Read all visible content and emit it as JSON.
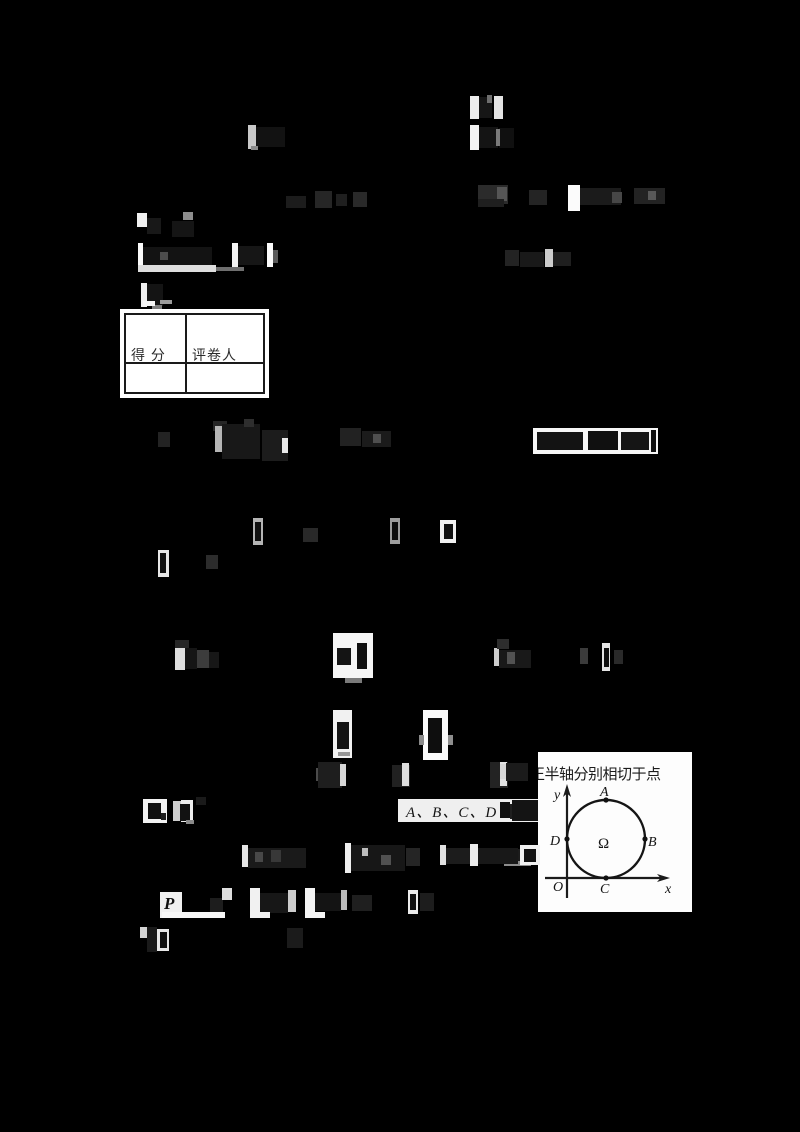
{
  "colors": {
    "page_background": "#000000",
    "paper_white": "#ffffff",
    "ink": "#1b1b1b"
  },
  "score_table": {
    "score_label": "得 分",
    "grader_label": "评卷人"
  },
  "figure": {
    "caption": "正半轴分别相切于点",
    "labels": {
      "y_axis": "y",
      "x_axis": "x",
      "origin": "O",
      "point_a": "A",
      "point_b": "B",
      "point_c": "C",
      "point_d": "D",
      "center": "Ω"
    }
  },
  "text_fragments": {
    "options": "A、B、C、D",
    "p_symbol": "P"
  },
  "fragments": [
    [
      470,
      96,
      9,
      23,
      "#ededed"
    ],
    [
      479,
      97,
      13,
      21,
      "#161616"
    ],
    [
      487,
      95,
      5,
      8,
      "#6e6e6e"
    ],
    [
      494,
      96,
      9,
      23,
      "#e3e3e3"
    ],
    [
      470,
      125,
      9,
      25,
      "#f3f3f3"
    ],
    [
      479,
      127,
      19,
      21,
      "#141414"
    ],
    [
      499,
      128,
      15,
      20,
      "#101010"
    ],
    [
      496,
      129,
      4,
      17,
      "#7a7a7a"
    ],
    [
      248,
      125,
      8,
      24,
      "#c9c9c9"
    ],
    [
      256,
      127,
      29,
      20,
      "#121212"
    ],
    [
      251,
      146,
      7,
      4,
      "#8a8a8a"
    ],
    [
      286,
      196,
      20,
      12,
      "#1c1c1c"
    ],
    [
      315,
      191,
      17,
      17,
      "#262626"
    ],
    [
      336,
      194,
      11,
      12,
      "#1f1f1f"
    ],
    [
      353,
      192,
      14,
      15,
      "#292929"
    ],
    [
      478,
      185,
      30,
      19,
      "#2b2b2b"
    ],
    [
      497,
      187,
      10,
      14,
      "#555555"
    ],
    [
      478,
      199,
      26,
      8,
      "#1f1f1f"
    ],
    [
      529,
      190,
      18,
      15,
      "#242424"
    ],
    [
      568,
      185,
      12,
      26,
      "#fbfbfb"
    ],
    [
      580,
      188,
      41,
      17,
      "#1b1b1b"
    ],
    [
      612,
      192,
      10,
      11,
      "#474747"
    ],
    [
      634,
      188,
      31,
      16,
      "#232323"
    ],
    [
      648,
      191,
      8,
      9,
      "#585858"
    ],
    [
      137,
      213,
      10,
      14,
      "#f0f0f0"
    ],
    [
      147,
      218,
      14,
      16,
      "#181818"
    ],
    [
      183,
      212,
      10,
      8,
      "#8d8d8d"
    ],
    [
      172,
      221,
      22,
      16,
      "#151515"
    ],
    [
      138,
      243,
      5,
      25,
      "#fafafa"
    ],
    [
      143,
      247,
      69,
      18,
      "#131313"
    ],
    [
      160,
      252,
      8,
      8,
      "#4d4d4d"
    ],
    [
      138,
      265,
      78,
      7,
      "#dedede"
    ],
    [
      216,
      267,
      28,
      4,
      "#6f6f6f"
    ],
    [
      232,
      243,
      6,
      24,
      "#f4f4f4"
    ],
    [
      238,
      246,
      26,
      19,
      "#161616"
    ],
    [
      267,
      243,
      6,
      24,
      "#fafafa"
    ],
    [
      273,
      250,
      5,
      13,
      "#5a5a5a"
    ],
    [
      505,
      250,
      14,
      16,
      "#232323"
    ],
    [
      520,
      252,
      24,
      15,
      "#191919"
    ],
    [
      545,
      249,
      8,
      18,
      "#cccccc"
    ],
    [
      553,
      252,
      18,
      14,
      "#1f1f1f"
    ],
    [
      141,
      283,
      6,
      24,
      "#efefef"
    ],
    [
      147,
      284,
      16,
      22,
      "#141414"
    ],
    [
      152,
      305,
      10,
      4,
      "#7c7c7c"
    ],
    [
      143,
      301,
      12,
      5,
      "#f5f5f5"
    ],
    [
      160,
      300,
      12,
      4,
      "#9b9b9b"
    ],
    [
      158,
      432,
      12,
      15,
      "#232323"
    ],
    [
      213,
      421,
      14,
      10,
      "#262626"
    ],
    [
      215,
      426,
      7,
      26,
      "#b5b5b5"
    ],
    [
      222,
      424,
      38,
      35,
      "#181818"
    ],
    [
      244,
      419,
      10,
      8,
      "#2e2e2e"
    ],
    [
      262,
      430,
      26,
      31,
      "#1c1c1c"
    ],
    [
      282,
      438,
      6,
      15,
      "#e9e9e9"
    ],
    [
      340,
      428,
      21,
      18,
      "#222222"
    ],
    [
      362,
      431,
      29,
      16,
      "#1b1b1b"
    ],
    [
      373,
      434,
      8,
      9,
      "#4f4f4f"
    ],
    [
      533,
      428,
      125,
      26,
      "#f6f6f6"
    ],
    [
      537,
      432,
      46,
      18,
      "#131313"
    ],
    [
      588,
      431,
      30,
      19,
      "#101010"
    ],
    [
      621,
      432,
      28,
      18,
      "#151515"
    ],
    [
      651,
      430,
      5,
      22,
      "#111111"
    ],
    [
      253,
      518,
      10,
      27,
      "#b4b4b4"
    ],
    [
      255,
      522,
      6,
      19,
      "#101010"
    ],
    [
      303,
      528,
      15,
      14,
      "#292929"
    ],
    [
      390,
      518,
      10,
      26,
      "#9e9e9e"
    ],
    [
      392,
      522,
      6,
      18,
      "#0f0f0f"
    ],
    [
      440,
      520,
      16,
      23,
      "#f1f1f1"
    ],
    [
      444,
      524,
      9,
      15,
      "#111111"
    ],
    [
      158,
      550,
      11,
      27,
      "#e7e7e7"
    ],
    [
      160,
      553,
      6,
      20,
      "#101010"
    ],
    [
      206,
      555,
      12,
      14,
      "#2c2c2c"
    ],
    [
      175,
      640,
      14,
      8,
      "#272727"
    ],
    [
      175,
      648,
      10,
      22,
      "#dedede"
    ],
    [
      185,
      648,
      12,
      21,
      "#151515"
    ],
    [
      197,
      650,
      12,
      18,
      "#3c3c3c"
    ],
    [
      209,
      652,
      10,
      16,
      "#171717"
    ],
    [
      333,
      633,
      40,
      45,
      "#f5f5f5"
    ],
    [
      337,
      648,
      14,
      17,
      "#141414"
    ],
    [
      357,
      643,
      10,
      26,
      "#0f0f0f"
    ],
    [
      345,
      678,
      17,
      5,
      "#7a7a7a"
    ],
    [
      494,
      648,
      5,
      18,
      "#cdcdcd"
    ],
    [
      497,
      639,
      12,
      10,
      "#2d2d2d"
    ],
    [
      499,
      650,
      32,
      18,
      "#191919"
    ],
    [
      507,
      652,
      8,
      12,
      "#525252"
    ],
    [
      580,
      648,
      8,
      16,
      "#3b3b3b"
    ],
    [
      602,
      643,
      8,
      28,
      "#e4e4e4"
    ],
    [
      604,
      648,
      5,
      19,
      "#0f0f0f"
    ],
    [
      614,
      650,
      9,
      14,
      "#2a2a2a"
    ],
    [
      333,
      710,
      19,
      48,
      "#f1f1f1"
    ],
    [
      337,
      722,
      12,
      27,
      "#131313"
    ],
    [
      338,
      752,
      12,
      4,
      "#969696"
    ],
    [
      423,
      710,
      25,
      50,
      "#fafafa"
    ],
    [
      428,
      718,
      14,
      35,
      "#0e0e0e"
    ],
    [
      419,
      735,
      5,
      10,
      "#898989"
    ],
    [
      448,
      735,
      5,
      10,
      "#8e8e8e"
    ],
    [
      316,
      768,
      8,
      13,
      "#4b4b4b"
    ],
    [
      318,
      762,
      24,
      26,
      "#1e1e1e"
    ],
    [
      340,
      764,
      6,
      22,
      "#d6d6d6"
    ],
    [
      392,
      765,
      18,
      22,
      "#212121"
    ],
    [
      402,
      763,
      7,
      23,
      "#dedede"
    ],
    [
      490,
      762,
      18,
      26,
      "#232323"
    ],
    [
      500,
      762,
      7,
      24,
      "#e2e2e2"
    ],
    [
      500,
      764,
      6,
      15,
      "#d6d6d6"
    ],
    [
      506,
      763,
      22,
      18,
      "#1b1b1b"
    ],
    [
      500,
      802,
      10,
      16,
      "#101010"
    ],
    [
      510,
      804,
      24,
      15,
      "#1f1f1f"
    ],
    [
      514,
      807,
      8,
      8,
      "#565656"
    ],
    [
      502,
      849,
      30,
      13,
      "#1c1c1c"
    ],
    [
      504,
      861,
      27,
      5,
      "#8c8c8c"
    ],
    [
      143,
      799,
      24,
      24,
      "#f2f2f2"
    ],
    [
      148,
      803,
      13,
      16,
      "#101010"
    ],
    [
      161,
      813,
      5,
      7,
      "#1e1e1e"
    ],
    [
      173,
      801,
      8,
      20,
      "#cecece"
    ],
    [
      181,
      800,
      12,
      22,
      "#eeeeee"
    ],
    [
      180,
      804,
      10,
      17,
      "#121212"
    ],
    [
      186,
      820,
      8,
      4,
      "#8a8a8a"
    ],
    [
      196,
      797,
      10,
      8,
      "#1a1a1a"
    ],
    [
      512,
      800,
      26,
      21,
      "#141414"
    ],
    [
      242,
      845,
      6,
      22,
      "#e6e6e6"
    ],
    [
      248,
      848,
      58,
      20,
      "#1a1a1a"
    ],
    [
      255,
      852,
      8,
      10,
      "#484848"
    ],
    [
      271,
      850,
      10,
      12,
      "#383838"
    ],
    [
      345,
      843,
      6,
      30,
      "#efefef"
    ],
    [
      351,
      845,
      54,
      26,
      "#171717"
    ],
    [
      362,
      848,
      6,
      8,
      "#bdbdbd"
    ],
    [
      381,
      855,
      10,
      10,
      "#515151"
    ],
    [
      406,
      848,
      14,
      18,
      "#252525"
    ],
    [
      440,
      845,
      6,
      20,
      "#e2e2e2"
    ],
    [
      446,
      848,
      24,
      16,
      "#1c1c1c"
    ],
    [
      470,
      844,
      8,
      22,
      "#ececec"
    ],
    [
      478,
      848,
      40,
      16,
      "#181818"
    ],
    [
      520,
      845,
      20,
      20,
      "#f0f0f0"
    ],
    [
      524,
      849,
      12,
      13,
      "#111111"
    ],
    [
      210,
      898,
      13,
      16,
      "#1d1d1d"
    ],
    [
      222,
      888,
      10,
      12,
      "#dedede"
    ],
    [
      250,
      888,
      10,
      26,
      "#f1f1f1"
    ],
    [
      260,
      893,
      28,
      20,
      "#171717"
    ],
    [
      288,
      890,
      8,
      22,
      "#cdcdcd"
    ],
    [
      305,
      888,
      10,
      24,
      "#f4f4f4"
    ],
    [
      315,
      893,
      26,
      18,
      "#141414"
    ],
    [
      341,
      890,
      6,
      20,
      "#bbbbbb"
    ],
    [
      352,
      895,
      20,
      16,
      "#1f1f1f"
    ],
    [
      408,
      890,
      10,
      24,
      "#ebebeb"
    ],
    [
      410,
      894,
      6,
      16,
      "#101010"
    ],
    [
      420,
      893,
      14,
      18,
      "#1d1d1d"
    ],
    [
      162,
      912,
      63,
      6,
      "#f7f7f7"
    ],
    [
      250,
      912,
      20,
      6,
      "#f2f2f2"
    ],
    [
      305,
      912,
      20,
      6,
      "#f4f4f4"
    ],
    [
      140,
      927,
      7,
      11,
      "#d3d3d3"
    ],
    [
      147,
      927,
      10,
      25,
      "#1a1a1a"
    ],
    [
      157,
      929,
      12,
      22,
      "#e8e8e8"
    ],
    [
      160,
      932,
      7,
      16,
      "#111111"
    ],
    [
      287,
      928,
      16,
      20,
      "#1b1b1b"
    ]
  ]
}
